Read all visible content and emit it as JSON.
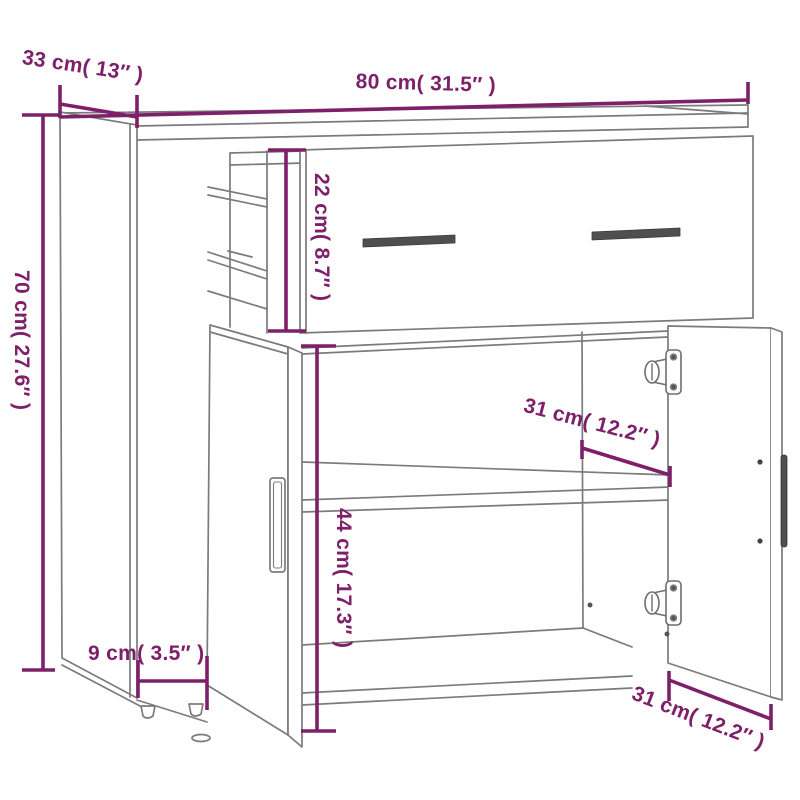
{
  "figure": {
    "kind": "product-dimension-diagram",
    "background": "#ffffff"
  },
  "dimensions": {
    "width": "80 cm( 31.5″ )",
    "depth": "33 cm( 13″ )",
    "height": "70 cm( 27.6″ )",
    "drawer_height": "22 cm( 8.7″ )",
    "shelf_depth": "31 cm( 12.2″ )",
    "compartment_height": "44 cm( 17.3″ )",
    "leg_height": "9 cm( 3.5″ )",
    "door_bottom_width": "31 cm( 12.2″ )"
  },
  "colors": {
    "dimension_accent": "#7d2069",
    "line_gray": "#7b7b7b",
    "hardware_dark": "#4f4f4f"
  }
}
